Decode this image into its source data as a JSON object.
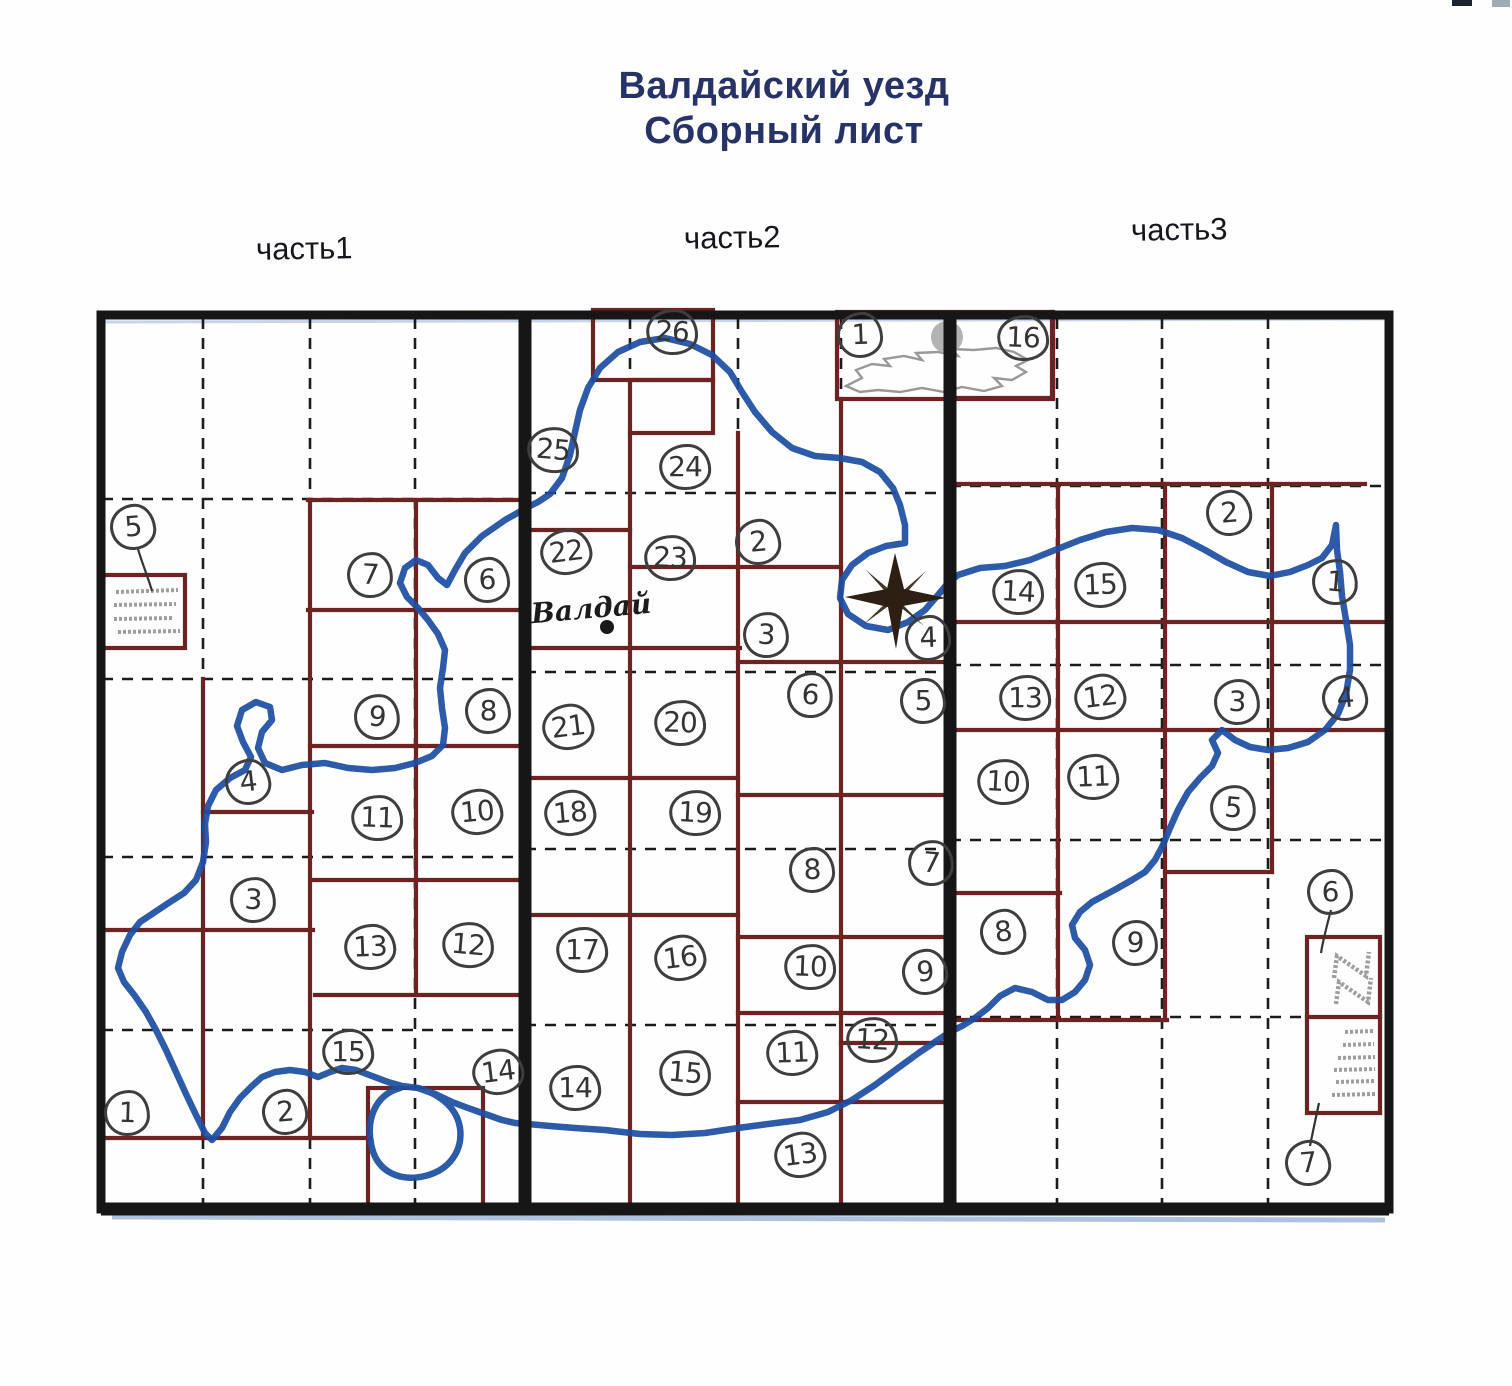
{
  "title": {
    "line1": "Валдайский уезд",
    "line2": "Сборный лист"
  },
  "sections": [
    {
      "label": "часть1"
    },
    {
      "label": "часть2"
    },
    {
      "label": "часть3"
    }
  ],
  "place_label": "Валдай",
  "colors": {
    "border_black": "#161616",
    "sheet_grid_maroon": "#6e2323",
    "boundary_river_blue": "#1d4fa2",
    "title_text": "#273266",
    "handwriting_ink": "#3a3a3a",
    "legend_gray": "#a2a2a2"
  },
  "legends": [
    {
      "id": "left-box",
      "linked_marker": "5",
      "part": 1
    },
    {
      "id": "right-box-top",
      "linked_marker": "6",
      "part": 3
    },
    {
      "id": "right-box-bottom",
      "linked_marker": "7",
      "part": 3
    }
  ],
  "markers": [
    {
      "part": 1,
      "n": "5",
      "x": 133,
      "y": 527
    },
    {
      "part": 1,
      "n": "7",
      "x": 370,
      "y": 575
    },
    {
      "part": 1,
      "n": "6",
      "x": 487,
      "y": 580
    },
    {
      "part": 1,
      "n": "9",
      "x": 377,
      "y": 717
    },
    {
      "part": 1,
      "n": "8",
      "x": 488,
      "y": 711
    },
    {
      "part": 1,
      "n": "4",
      "x": 248,
      "y": 782
    },
    {
      "part": 1,
      "n": "11",
      "x": 377,
      "y": 818
    },
    {
      "part": 1,
      "n": "10",
      "x": 477,
      "y": 812
    },
    {
      "part": 1,
      "n": "3",
      "x": 253,
      "y": 900
    },
    {
      "part": 1,
      "n": "13",
      "x": 370,
      "y": 947
    },
    {
      "part": 1,
      "n": "12",
      "x": 468,
      "y": 945
    },
    {
      "part": 1,
      "n": "15",
      "x": 348,
      "y": 1052
    },
    {
      "part": 1,
      "n": "14",
      "x": 498,
      "y": 1072
    },
    {
      "part": 1,
      "n": "1",
      "x": 127,
      "y": 1113
    },
    {
      "part": 1,
      "n": "2",
      "x": 285,
      "y": 1112
    },
    {
      "part": 2,
      "n": "26",
      "x": 672,
      "y": 332
    },
    {
      "part": 2,
      "n": "1",
      "x": 860,
      "y": 335
    },
    {
      "part": 2,
      "n": "25",
      "x": 553,
      "y": 450
    },
    {
      "part": 2,
      "n": "24",
      "x": 685,
      "y": 467
    },
    {
      "part": 2,
      "n": "22",
      "x": 566,
      "y": 552
    },
    {
      "part": 2,
      "n": "23",
      "x": 670,
      "y": 558
    },
    {
      "part": 2,
      "n": "2",
      "x": 758,
      "y": 542
    },
    {
      "part": 2,
      "n": "3",
      "x": 766,
      "y": 635
    },
    {
      "part": 2,
      "n": "4",
      "x": 928,
      "y": 638
    },
    {
      "part": 2,
      "n": "6",
      "x": 810,
      "y": 695
    },
    {
      "part": 2,
      "n": "5",
      "x": 923,
      "y": 701
    },
    {
      "part": 2,
      "n": "21",
      "x": 568,
      "y": 727
    },
    {
      "part": 2,
      "n": "20",
      "x": 680,
      "y": 723
    },
    {
      "part": 2,
      "n": "18",
      "x": 570,
      "y": 813
    },
    {
      "part": 2,
      "n": "19",
      "x": 695,
      "y": 813
    },
    {
      "part": 2,
      "n": "8",
      "x": 812,
      "y": 870
    },
    {
      "part": 2,
      "n": "7",
      "x": 931,
      "y": 863
    },
    {
      "part": 2,
      "n": "17",
      "x": 582,
      "y": 950
    },
    {
      "part": 2,
      "n": "16",
      "x": 680,
      "y": 958
    },
    {
      "part": 2,
      "n": "10",
      "x": 810,
      "y": 967
    },
    {
      "part": 2,
      "n": "9",
      "x": 925,
      "y": 972
    },
    {
      "part": 2,
      "n": "12",
      "x": 872,
      "y": 1040
    },
    {
      "part": 2,
      "n": "11",
      "x": 792,
      "y": 1053
    },
    {
      "part": 2,
      "n": "15",
      "x": 685,
      "y": 1073
    },
    {
      "part": 2,
      "n": "14",
      "x": 575,
      "y": 1088
    },
    {
      "part": 2,
      "n": "13",
      "x": 800,
      "y": 1155
    },
    {
      "part": 3,
      "n": "16",
      "x": 1023,
      "y": 338
    },
    {
      "part": 3,
      "n": "2",
      "x": 1229,
      "y": 513
    },
    {
      "part": 3,
      "n": "14",
      "x": 1018,
      "y": 592
    },
    {
      "part": 3,
      "n": "15",
      "x": 1100,
      "y": 585
    },
    {
      "part": 3,
      "n": "1",
      "x": 1335,
      "y": 582
    },
    {
      "part": 3,
      "n": "13",
      "x": 1025,
      "y": 698
    },
    {
      "part": 3,
      "n": "12",
      "x": 1100,
      "y": 697
    },
    {
      "part": 3,
      "n": "3",
      "x": 1237,
      "y": 702
    },
    {
      "part": 3,
      "n": "4",
      "x": 1345,
      "y": 698
    },
    {
      "part": 3,
      "n": "10",
      "x": 1003,
      "y": 782
    },
    {
      "part": 3,
      "n": "11",
      "x": 1093,
      "y": 777
    },
    {
      "part": 3,
      "n": "5",
      "x": 1233,
      "y": 808
    },
    {
      "part": 3,
      "n": "6",
      "x": 1330,
      "y": 892
    },
    {
      "part": 3,
      "n": "8",
      "x": 1003,
      "y": 932
    },
    {
      "part": 3,
      "n": "9",
      "x": 1135,
      "y": 943
    },
    {
      "part": 3,
      "n": "7",
      "x": 1308,
      "y": 1163
    }
  ]
}
